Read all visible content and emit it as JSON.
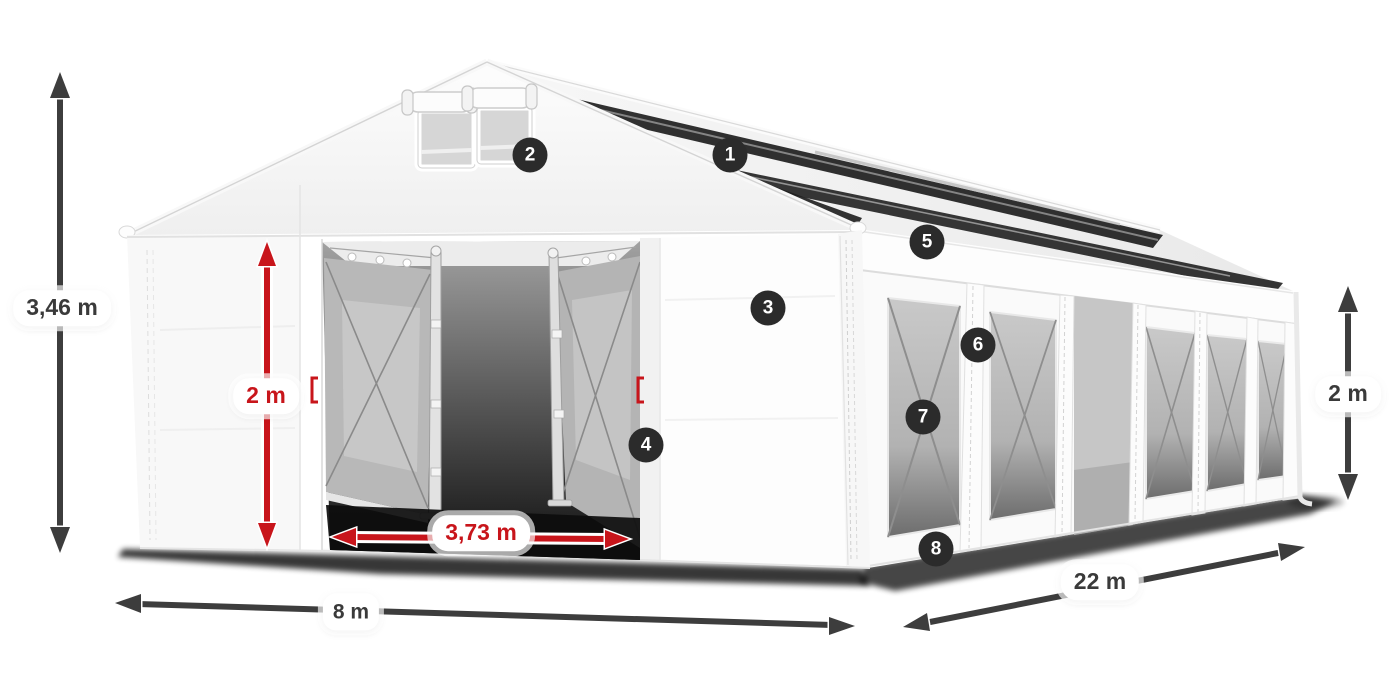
{
  "diagram": {
    "subject": "marquee-tent-dimension-diagram",
    "colors": {
      "accent_red": "#c8151b",
      "arrow_dark": "#3d3d3d",
      "badge_background": "#2b2b2b",
      "label_text": "#3a3a3a",
      "label_background": "#ffffff"
    },
    "dimensions": {
      "total_height": {
        "label": "3,46 m"
      },
      "door_height": {
        "label": "2 m"
      },
      "door_width": {
        "label": "3,73 m"
      },
      "front_width": {
        "label": "8 m"
      },
      "side_length": {
        "label": "22 m"
      },
      "side_height": {
        "label": "2 m"
      }
    },
    "callouts": [
      {
        "number": "1"
      },
      {
        "number": "2"
      },
      {
        "number": "3"
      },
      {
        "number": "4"
      },
      {
        "number": "5"
      },
      {
        "number": "6"
      },
      {
        "number": "7"
      },
      {
        "number": "8"
      }
    ]
  }
}
